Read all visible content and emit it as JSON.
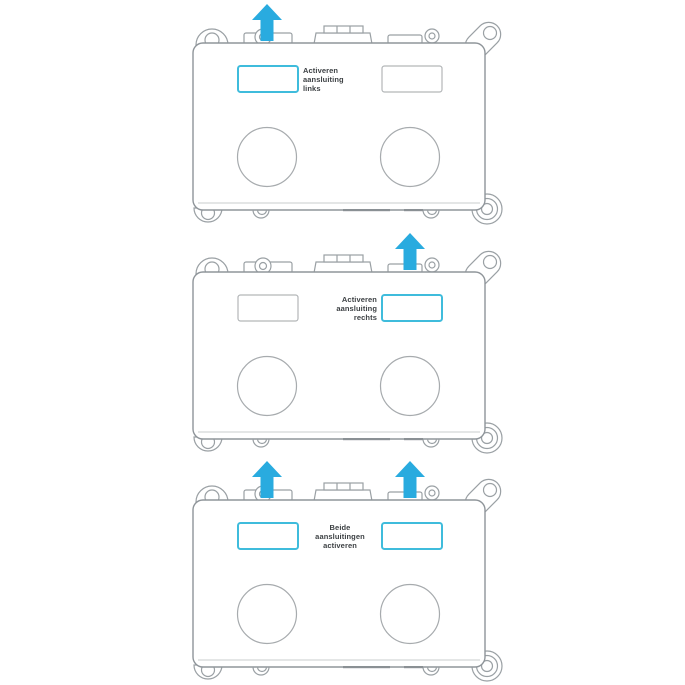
{
  "page": {
    "background": "#ffffff"
  },
  "colors": {
    "accent_arrow": "#29abdf",
    "active_border": "#3fbcdc",
    "inactive_border": "#b3b6b8",
    "line": "#9aa0a4",
    "text": "#3d4144"
  },
  "figures": [
    {
      "id": "activate-left-connection",
      "label": {
        "line1": "Activeren",
        "line2": "aansluiting",
        "line3": "links"
      },
      "arrows": {
        "left": "visible",
        "right": "hidden"
      },
      "left_button": {
        "state": "active",
        "border_color": "#3fbcdc",
        "border_width": "2"
      },
      "right_button": {
        "state": "inactive",
        "border_color": "#b3b6b8",
        "border_width": "1.2"
      }
    },
    {
      "id": "activate-right-connection",
      "label": {
        "line1": "Activeren",
        "line2": "aansluiting",
        "line3": "rechts"
      },
      "arrows": {
        "left": "hidden",
        "right": "visible"
      },
      "left_button": {
        "state": "inactive",
        "border_color": "#b3b6b8",
        "border_width": "1.2"
      },
      "right_button": {
        "state": "active",
        "border_color": "#3fbcdc",
        "border_width": "2"
      }
    },
    {
      "id": "activate-both-connections",
      "label": {
        "line1": "Beide",
        "line2": "aansluitingen",
        "line3": "activeren"
      },
      "arrows": {
        "left": "visible",
        "right": "visible"
      },
      "left_button": {
        "state": "active",
        "border_color": "#3fbcdc",
        "border_width": "2"
      },
      "right_button": {
        "state": "active",
        "border_color": "#3fbcdc",
        "border_width": "2"
      }
    }
  ]
}
